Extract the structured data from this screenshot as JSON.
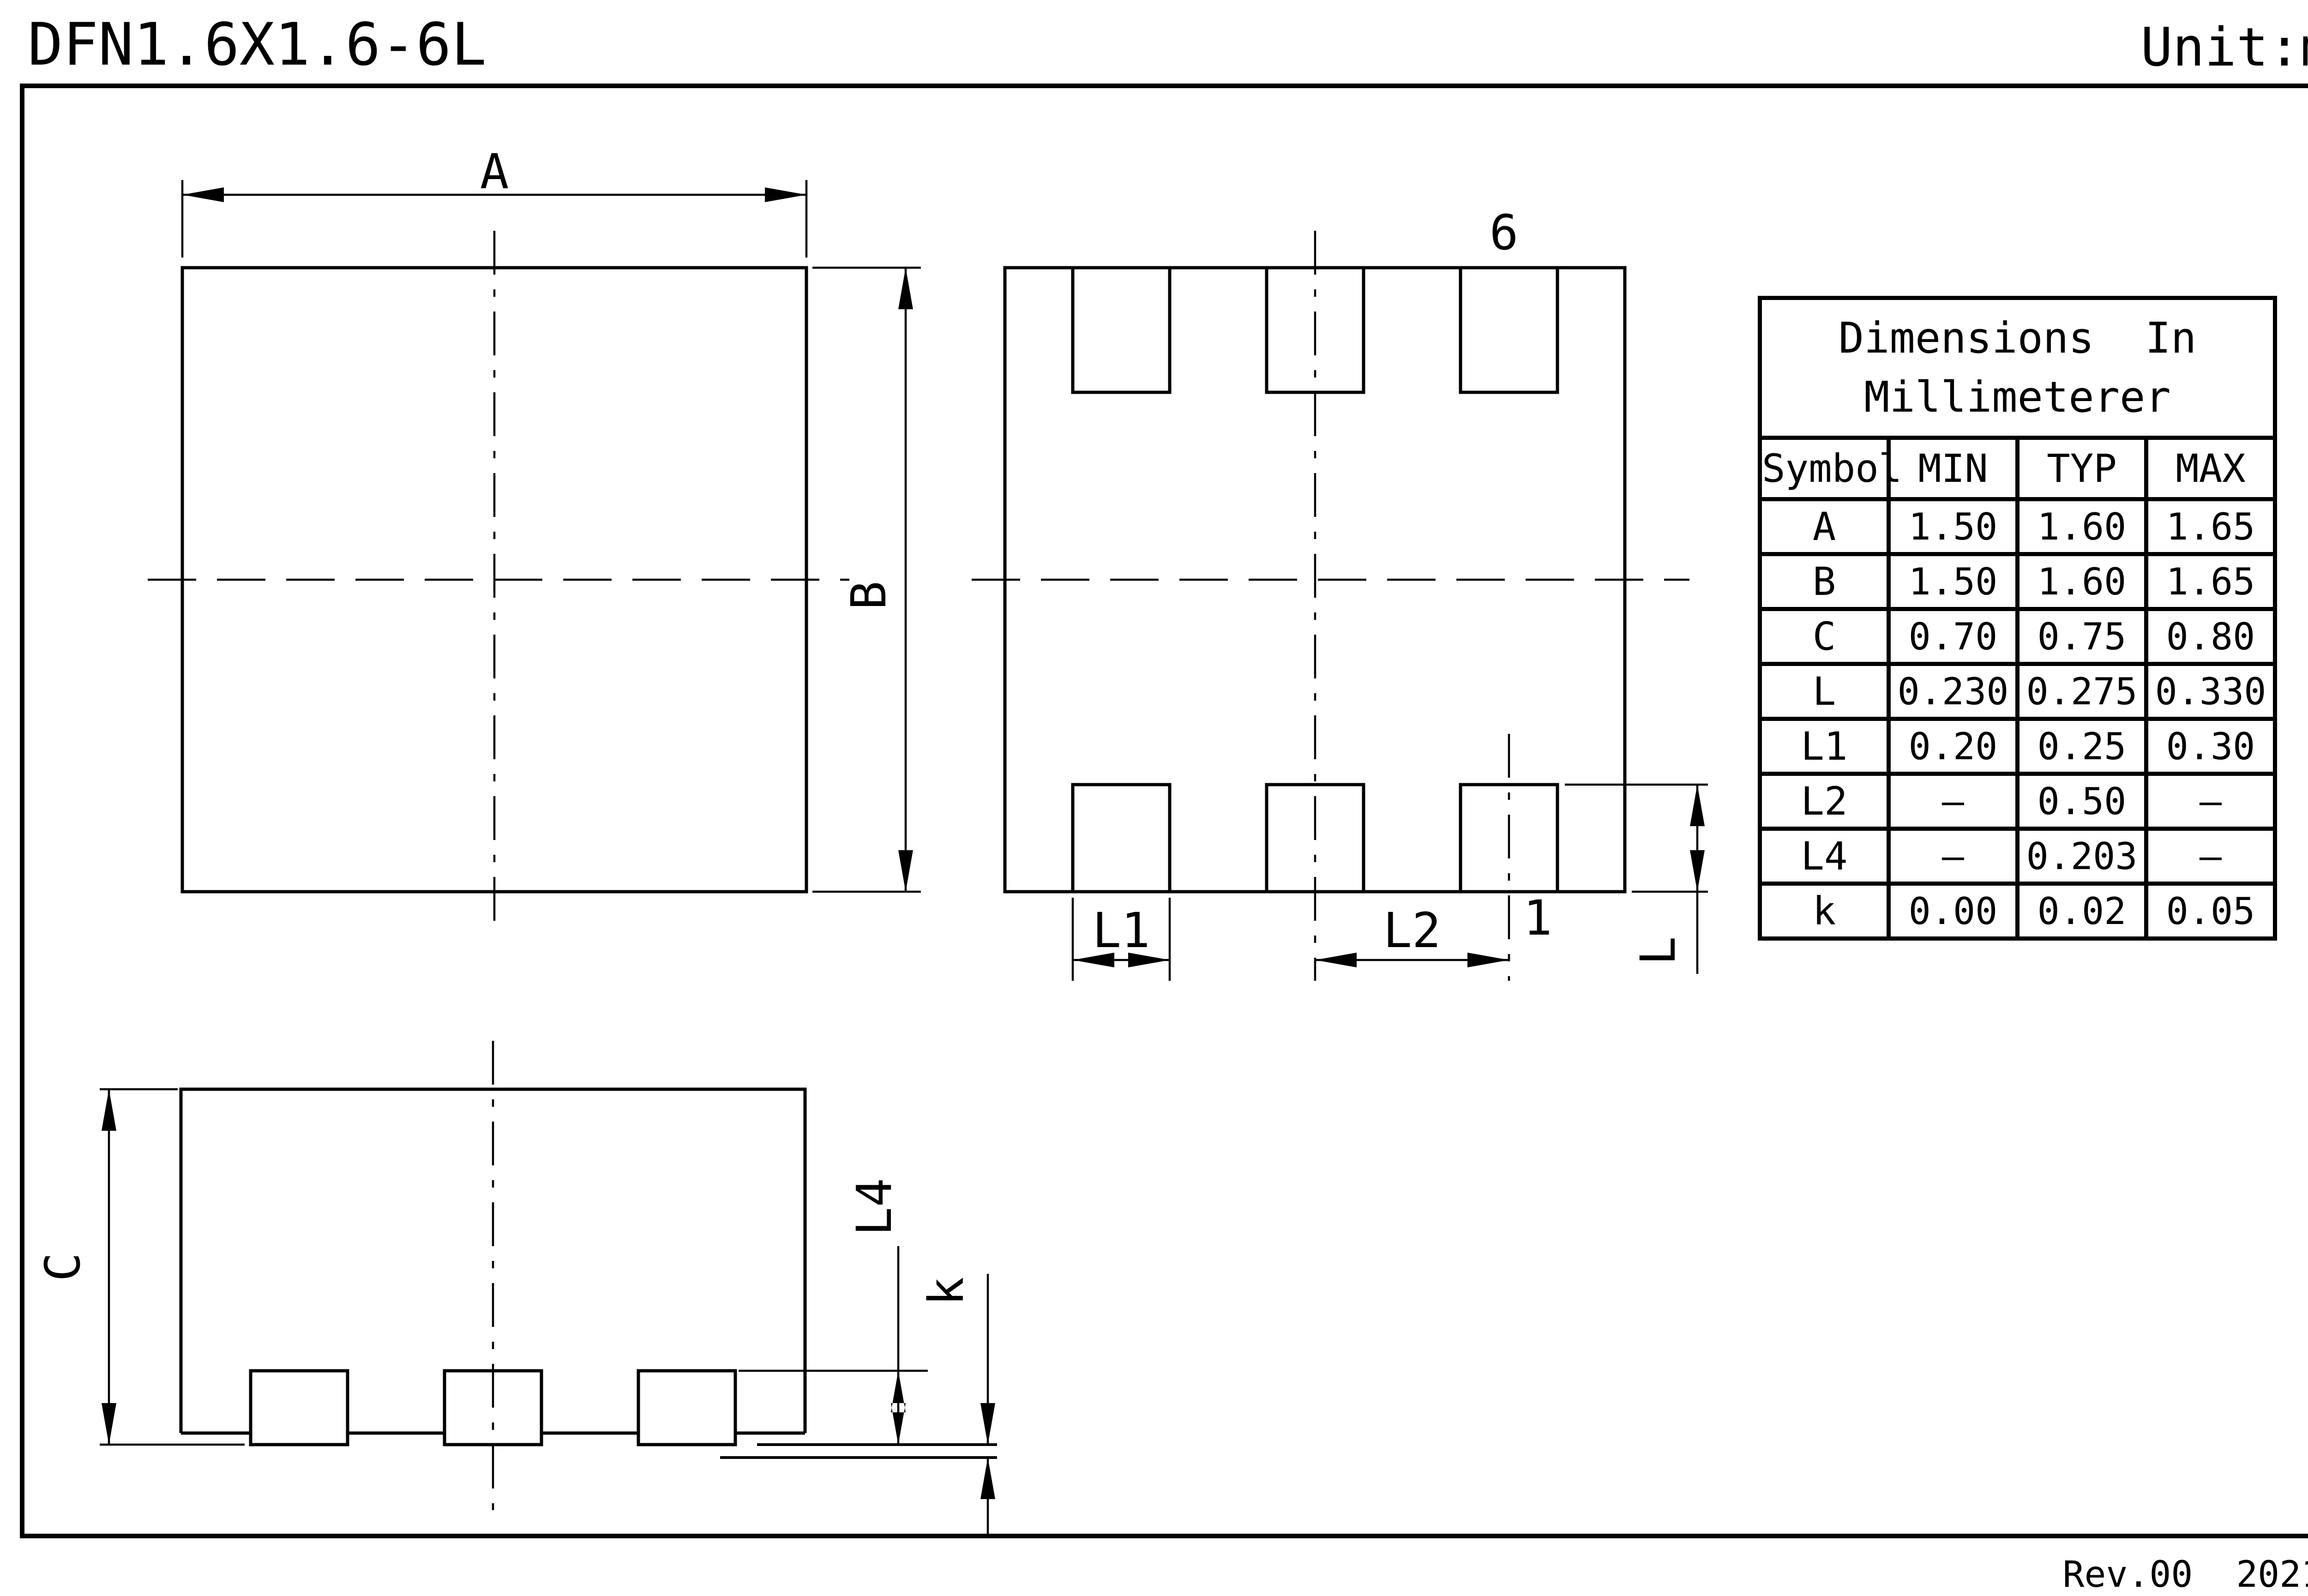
{
  "page": {
    "title": "DFN1.6X1.6-6L",
    "unit_label": "Unit:mm",
    "revision": "Rev.00  202107"
  },
  "drawing": {
    "top_view": {
      "dim_width": "A",
      "dim_height": "B"
    },
    "bottom_view": {
      "pin_six_label": "6",
      "pin_one_label": "1",
      "dim_pad_width": "L1",
      "dim_pad_pitch": "L2",
      "dim_pad_length": "L"
    },
    "side_view": {
      "dim_body_height": "C",
      "dim_terminal_length": "L4",
      "dim_standoff": "k"
    }
  },
  "table": {
    "title_line1": "Dimensions  In",
    "title_line2": "Millimeterer",
    "columns": [
      "Symbol",
      "MIN",
      "TYP",
      "MAX"
    ],
    "rows": [
      {
        "symbol": "A",
        "min": "1.50",
        "typ": "1.60",
        "max": "1.65"
      },
      {
        "symbol": "B",
        "min": "1.50",
        "typ": "1.60",
        "max": "1.65"
      },
      {
        "symbol": "C",
        "min": "0.70",
        "typ": "0.75",
        "max": "0.80"
      },
      {
        "symbol": "L",
        "min": "0.230",
        "typ": "0.275",
        "max": "0.330"
      },
      {
        "symbol": "L1",
        "min": "0.20",
        "typ": "0.25",
        "max": "0.30"
      },
      {
        "symbol": "L2",
        "min": "–",
        "typ": "0.50",
        "max": "–"
      },
      {
        "symbol": "L4",
        "min": "–",
        "typ": "0.203",
        "max": "–"
      },
      {
        "symbol": "k",
        "min": "0.00",
        "typ": "0.02",
        "max": "0.05"
      }
    ]
  },
  "colors": {
    "ink": "#000000",
    "paper": "#ffffff"
  }
}
